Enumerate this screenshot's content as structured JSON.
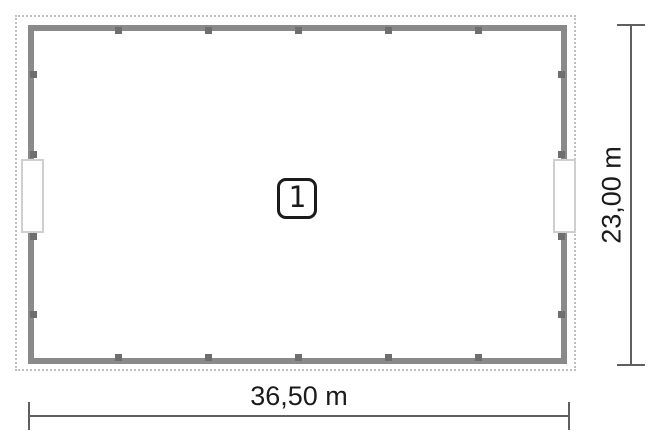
{
  "floor_plan": {
    "room_badge": {
      "number": "1"
    },
    "dimensions": {
      "width": {
        "label": "36,50 m"
      },
      "height": {
        "label": "23,00 m"
      }
    },
    "colors": {
      "wall": "#8a8a8a",
      "column_marker": "#6e6e6e",
      "plot_boundary": "#bdbdbd",
      "dimension_line": "#5f5f5f",
      "text": "#1b1b1b",
      "opening_border": "#cfcfcf"
    }
  }
}
